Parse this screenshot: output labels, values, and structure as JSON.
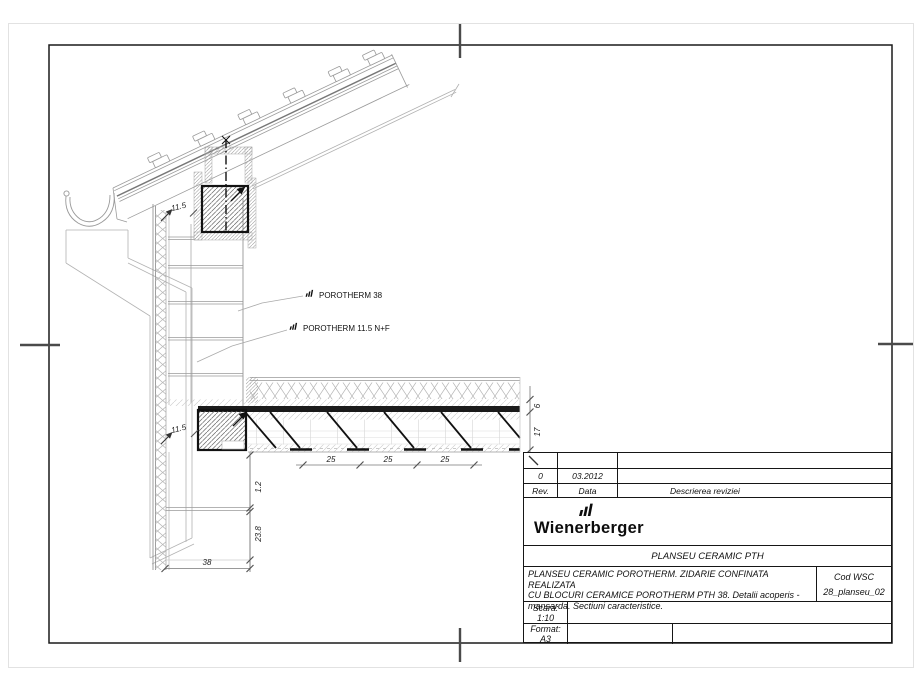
{
  "page": {
    "background": "#ffffff",
    "line_color": "#1a1a1a"
  },
  "drawing": {
    "callouts": {
      "block38": "POROTHERM 38",
      "block115": "POROTHERM 11.5 N+F"
    },
    "dims": {
      "leaf_upper": "11.5",
      "leaf_slab": "11.5",
      "spacing": [
        "25",
        "25",
        "25"
      ],
      "topping": "6",
      "slab": "17",
      "screed": "1.2",
      "block": "23.8",
      "wall": "38"
    }
  },
  "title_block": {
    "revisions": {
      "rev_value": "0",
      "date_value": "03.2012",
      "rev_label": "Rev.",
      "date_label": "Data",
      "desc_label": "Descrierea reviziei"
    },
    "brand": "Wienerberger",
    "doc_title": "PLANSEU CERAMIC PTH",
    "description": {
      "line1": "PLANSEU CERAMIC POROTHERM. ZIDARIE CONFINATA REALIZATA",
      "line2": "CU BLOCURI CERAMICE POROTHERM PTH 38. Detalii acoperis -",
      "line3": "mansarda. Sectiuni caracteristice."
    },
    "code_label": "Cod WSC",
    "code_value": "28_planseu_02",
    "scale_label": "Scara:",
    "scale_value": "1:10",
    "format_label": "Format:",
    "format_value": "A3"
  }
}
